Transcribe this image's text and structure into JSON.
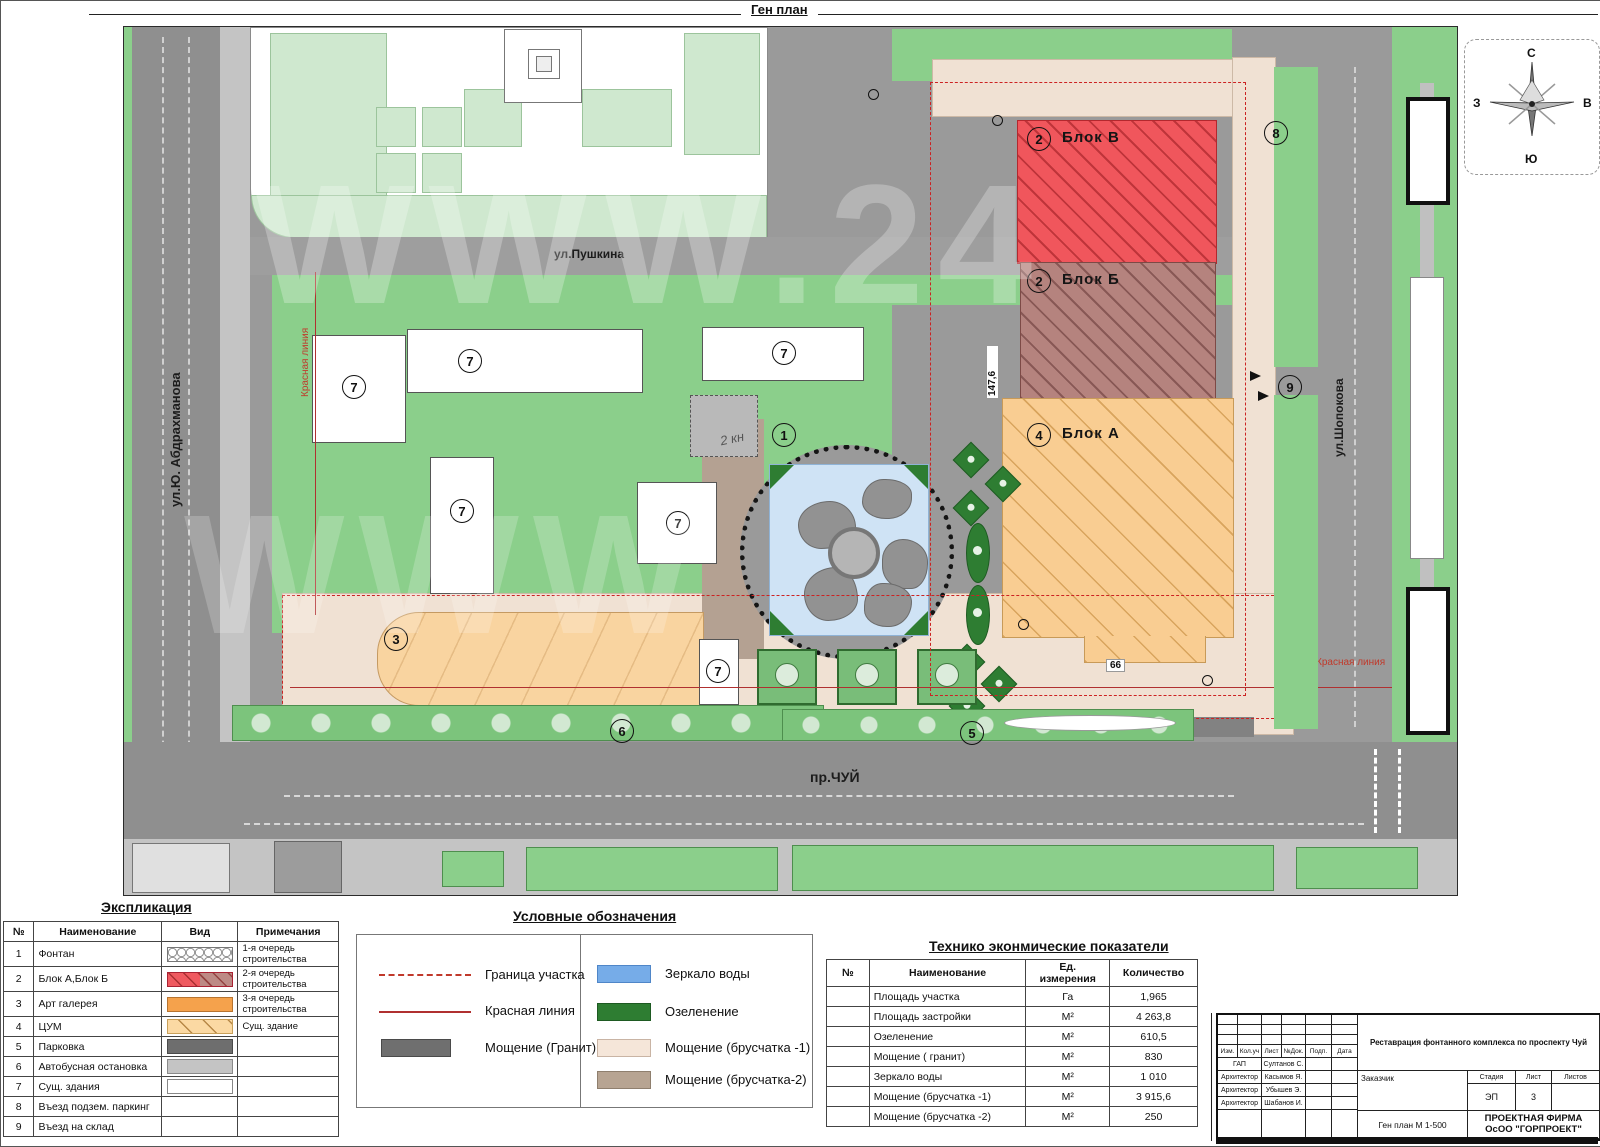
{
  "sheet": {
    "title": "Ген план"
  },
  "map": {
    "streets": {
      "pushkina": "ул.Пушкина",
      "abdrakhmanova": "ул.Ю. Абдрахманова",
      "chui": "пр.ЧУЙ",
      "shopokova": "ул.Шопокова"
    },
    "blocks": {
      "v": "Блок В",
      "b": "Блок Б",
      "a": "Блок А"
    },
    "labels": {
      "red_line_left": "Красная линия",
      "red_line_right": "Красная линия",
      "note_2kn": "2 кн"
    },
    "dims": {
      "d147": "147,6",
      "d66": "66"
    },
    "markers": {
      "m1": "1",
      "m2": "2",
      "m3": "3",
      "m4": "4",
      "m5": "5",
      "m6": "6",
      "m7": "7",
      "m8": "8",
      "m9": "9"
    },
    "watermark": "WWW.24",
    "watermark2": "WWW"
  },
  "compass": {
    "n": "С",
    "s": "Ю",
    "w": "З",
    "e": "В"
  },
  "explication": {
    "title": "Экспликация",
    "headers": [
      "№",
      "Наименование",
      "Вид",
      "Примечания"
    ],
    "rows": [
      {
        "num": "1",
        "name": "Фонтан",
        "note": "1-я очередь строительства"
      },
      {
        "num": "2",
        "name": "Блок А,Блок Б",
        "note": "2-я очередь строительства"
      },
      {
        "num": "3",
        "name": "Арт галерея",
        "note": "3-я очередь строительства"
      },
      {
        "num": "4",
        "name": "ЦУМ",
        "note": "Сущ. здание"
      },
      {
        "num": "5",
        "name": "Парковка",
        "note": ""
      },
      {
        "num": "6",
        "name": "Автобусная остановка",
        "note": ""
      },
      {
        "num": "7",
        "name": "Сущ. здания",
        "note": ""
      },
      {
        "num": "8",
        "name": "Въезд подзем. паркинг",
        "note": ""
      },
      {
        "num": "9",
        "name": "Въезд на склад",
        "note": ""
      }
    ]
  },
  "legend": {
    "title": "Условные обозначения",
    "items": {
      "boundary": "Граница участка",
      "red_line": "Красная линия",
      "granite": "Мощение (Гранит)",
      "water": "Зеркало воды",
      "greenery": "Озеленение",
      "pav1": "Мощение (брусчатка -1)",
      "pav2": "Мощение (брусчатка-2)"
    }
  },
  "tei": {
    "title": "Технико эконмические показатели",
    "headers": [
      "№",
      "Наименование",
      "Ед. измерения",
      "Количество"
    ],
    "rows": [
      {
        "name": "Площадь   участка",
        "unit": "Га",
        "qty": "1,965"
      },
      {
        "name": "Площадь застройки",
        "unit": "М²",
        "qty": "4 263,8"
      },
      {
        "name": "Озеленение",
        "unit": "М²",
        "qty": "610,5"
      },
      {
        "name": "Мощение ( гранит)",
        "unit": "М²",
        "qty": "830"
      },
      {
        "name": "Зеркало воды",
        "unit": "М²",
        "qty": "1 010"
      },
      {
        "name": "Мощение (брусчатка -1)",
        "unit": "М²",
        "qty": "3 915,6"
      },
      {
        "name": "Мощение (брусчатка -2)",
        "unit": "М²",
        "qty": "250"
      }
    ]
  },
  "stamp": {
    "cols": [
      "Изм.",
      "Кол.уч",
      "Лист",
      "№Док.",
      "Подп.",
      "Дата"
    ],
    "rows": [
      {
        "role": "ГАП",
        "name": "Султанов С."
      },
      {
        "role": "Архитектор",
        "name": "Касымов Я."
      },
      {
        "role": "Архитектор",
        "name": "Убышев Э."
      },
      {
        "role": "Архитектор",
        "name": "Шабанов И."
      }
    ],
    "project": "Реставрация фонтанного комплекса по проспекту Чуй",
    "customer": "Заказчик",
    "stage_headers": [
      "Стадия",
      "Лист",
      "Листов"
    ],
    "stage_values": {
      "stage": "ЭП",
      "sheet": "3",
      "sheets": ""
    },
    "doc": "Ген план М 1-500",
    "firm1": "ПРОЕКТНАЯ ФИРМА",
    "firm2": "ОсОО \"ГОРПРОЕКТ\""
  },
  "colors": {
    "block_v_red": "#f0565c",
    "block_b_brown": "#b5837e",
    "block_a_orange": "#f9cd92",
    "art_gallery_orange": "#f9d4a0",
    "greenery": "#8bcf8b",
    "dark_green": "#2e7d32",
    "water_blue": "#cfe3f5",
    "paving_cream": "#f0e1d3",
    "paving_tan": "#b4a192",
    "road_gray": "#9a9a9a",
    "red_line": "#c0392b"
  }
}
